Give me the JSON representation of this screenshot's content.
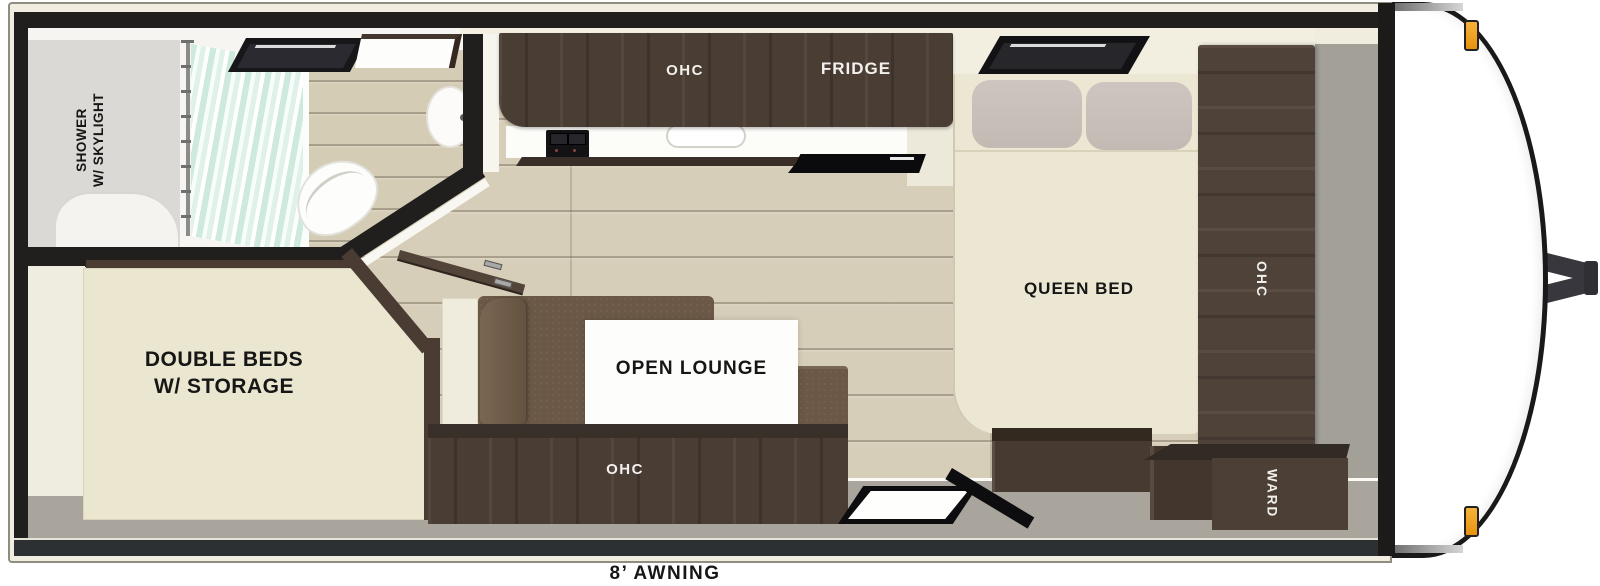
{
  "title": "Travel trailer floor plan",
  "labels": {
    "bathroom": {
      "line1": "SHOWER",
      "line2": "W/ SKYLIGHT"
    },
    "kitchen": {
      "overhead_cabinet": "OHC",
      "fridge": "FRIDGE"
    },
    "front_bedroom": {
      "bed": "QUEEN BED",
      "overhead_cabinet": "OHC",
      "wardrobe": "WARD"
    },
    "rear_bedroom": {
      "line1": "DOUBLE BEDS",
      "line2": "W/ STORAGE"
    },
    "lounge": {
      "name": "OPEN LOUNGE",
      "overhead_cabinet": "OHC"
    },
    "awning": "8’ AWNING"
  },
  "colors": {
    "wall_black": "#201f1d",
    "body_cream": "#f1eee1",
    "wood_floor": "#d7ceb9",
    "cabinet_wood": "#4a3d34",
    "sofa_brown": "#6b5846",
    "bed_cream": "#ece7d2",
    "floor_gray": "#a9a59c",
    "marker_light_orange": "#f0a52e",
    "curtain_mint": "#d4ecdf"
  }
}
